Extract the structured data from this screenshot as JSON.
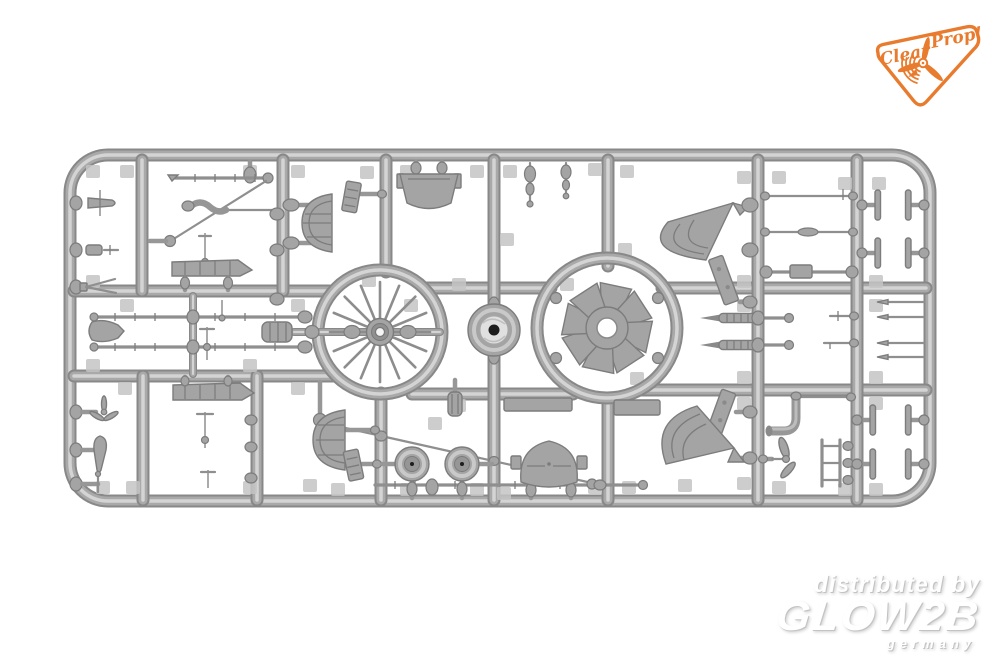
{
  "image": {
    "type": "product-photo",
    "subject": "gray injection-molded plastic model kit sprue with aircraft detail parts on white background"
  },
  "colors": {
    "bg": "#ffffff",
    "tube-dark": "#888888",
    "tube-mid": "#a9a9a9",
    "tube-hi": "#d4d4d4",
    "part-fill": "#a4a4a4",
    "part-dark": "#7c7c7c",
    "part-hi": "#c9c9c9",
    "tab": "#c4c4c4",
    "hole": "#1e1e1e",
    "logo-orange": "#e87b2d",
    "wm-fill": "#ffffff",
    "wm-shadow": "#c3c3c3"
  },
  "logo": {
    "brand_left": "Clear",
    "brand_right": "Prop!"
  },
  "watermark": {
    "line1": "distributed by",
    "brand": "GLOW2B",
    "country": "germany"
  },
  "sprue_parts": [
    "wire-spoked-wheel",
    "radial-fan",
    "cowling-ring-disc",
    "seat-bucket",
    "half-moon-bulkhead-top",
    "half-moon-bulkhead-bottom",
    "quarter-fan-cowl-top",
    "quarter-fan-cowl-bottom",
    "valve-pins",
    "machine-gun-barrels",
    "wing-strut-rods",
    "diagonal-struts",
    "airfoil-strips",
    "wheel-discs",
    "canopy-dome",
    "exhaust-pipe",
    "ladder-rack",
    "needle-rods",
    "t-shaped-parts",
    "louver-gills",
    "small-pins-and-forks"
  ]
}
